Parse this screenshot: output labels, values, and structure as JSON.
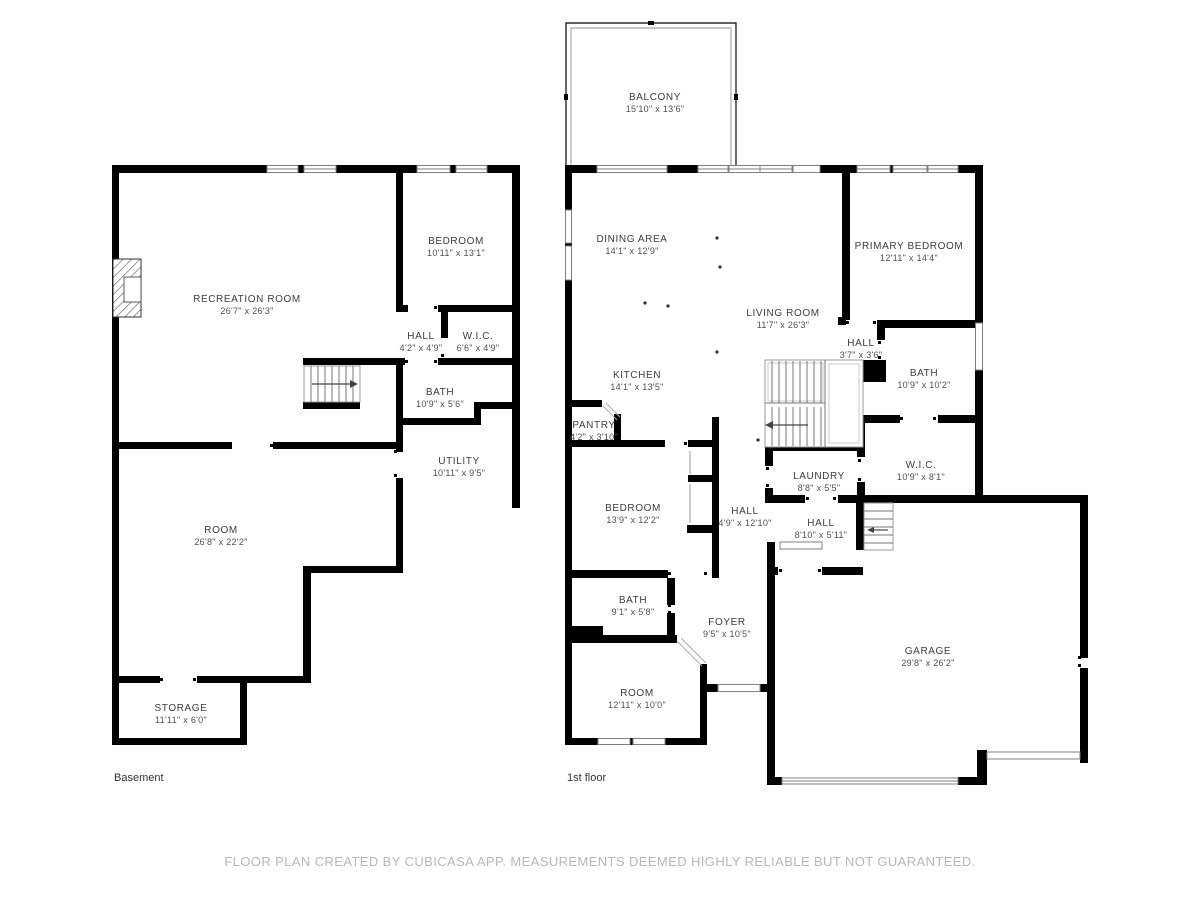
{
  "footer": {
    "disclaimer": "FLOOR PLAN CREATED BY CUBICASA APP. MEASUREMENTS DEEMED HIGHLY RELIABLE BUT NOT GUARANTEED."
  },
  "colors": {
    "wall": "#000000",
    "window_stroke": "#7f7f7f",
    "stair_stroke": "#9a9a9a",
    "label_text": "#3d3d3d",
    "footer_text": "#b7b7b7",
    "background": "#ffffff"
  },
  "floors": [
    {
      "caption": "Basement",
      "rooms": [
        {
          "name": "BEDROOM",
          "dims": "10'11\" x 13'1\""
        },
        {
          "name": "RECREATION ROOM",
          "dims": "26'7\" x 26'3\""
        },
        {
          "name": "HALL",
          "dims": "4'2\" x 4'9\""
        },
        {
          "name": "W.I.C.",
          "dims": "6'6\" x 4'9\""
        },
        {
          "name": "BATH",
          "dims": "10'9\" x 5'6\""
        },
        {
          "name": "UTILITY",
          "dims": "10'11\" x 9'5\""
        },
        {
          "name": "ROOM",
          "dims": "26'8\" x 22'2\""
        },
        {
          "name": "STORAGE",
          "dims": "11'11\" x 6'0\""
        }
      ]
    },
    {
      "caption": "1st floor",
      "rooms": [
        {
          "name": "BALCONY",
          "dims": "15'10\" x 13'6\""
        },
        {
          "name": "DINING AREA",
          "dims": "14'1\" x 12'9\""
        },
        {
          "name": "PRIMARY BEDROOM",
          "dims": "12'11\" x 14'4\""
        },
        {
          "name": "LIVING ROOM",
          "dims": "11'7\" x 26'3\""
        },
        {
          "name": "HALL",
          "dims": "3'7\" x 3'6\""
        },
        {
          "name": "BATH",
          "dims": "10'9\" x 10'2\""
        },
        {
          "name": "KITCHEN",
          "dims": "14'1\" x 13'5\""
        },
        {
          "name": "PANTRY",
          "dims": "4'2\" x 3'10\""
        },
        {
          "name": "LAUNDRY",
          "dims": "8'8\" x 5'5\""
        },
        {
          "name": "W.I.C.",
          "dims": "10'9\" x 8'1\""
        },
        {
          "name": "BEDROOM",
          "dims": "13'9\" x 12'2\""
        },
        {
          "name": "HALL",
          "dims": "4'9\" x 12'10\""
        },
        {
          "name": "HALL",
          "dims": "8'10\" x 5'11\""
        },
        {
          "name": "BATH",
          "dims": "9'1\" x 5'8\""
        },
        {
          "name": "FOYER",
          "dims": "9'5\" x 10'5\""
        },
        {
          "name": "ROOM",
          "dims": "12'11\" x 10'0\""
        },
        {
          "name": "GARAGE",
          "dims": "29'8\" x 26'2\""
        }
      ]
    }
  ]
}
